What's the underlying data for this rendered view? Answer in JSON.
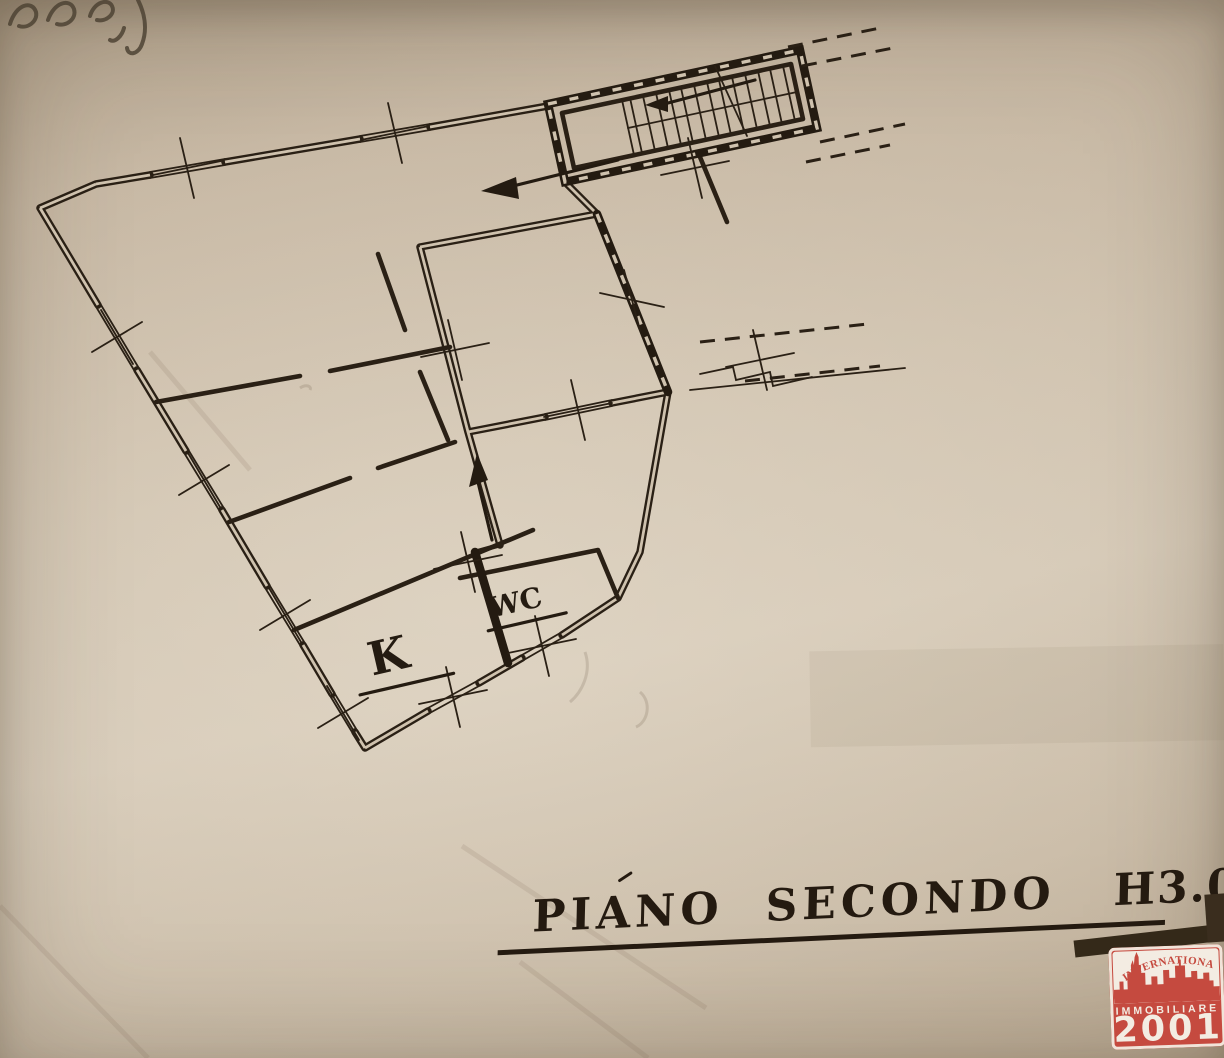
{
  "colors": {
    "paper": "#cfc2ae",
    "ink": "#2a2015",
    "logo_red": "#c54a3f",
    "logo_text_light": "#f3ece2"
  },
  "floor_plan": {
    "kitchen_label": "K",
    "wc_label": "WC"
  },
  "caption": {
    "full": "PIANO SECONDO H3.00",
    "word1": "PIANO",
    "word2": "SECONDO",
    "word3": "H3.00"
  },
  "logo": {
    "arc_text": "INTERNATIONAL",
    "name": "IMMOBILIARE",
    "number": "2001"
  }
}
